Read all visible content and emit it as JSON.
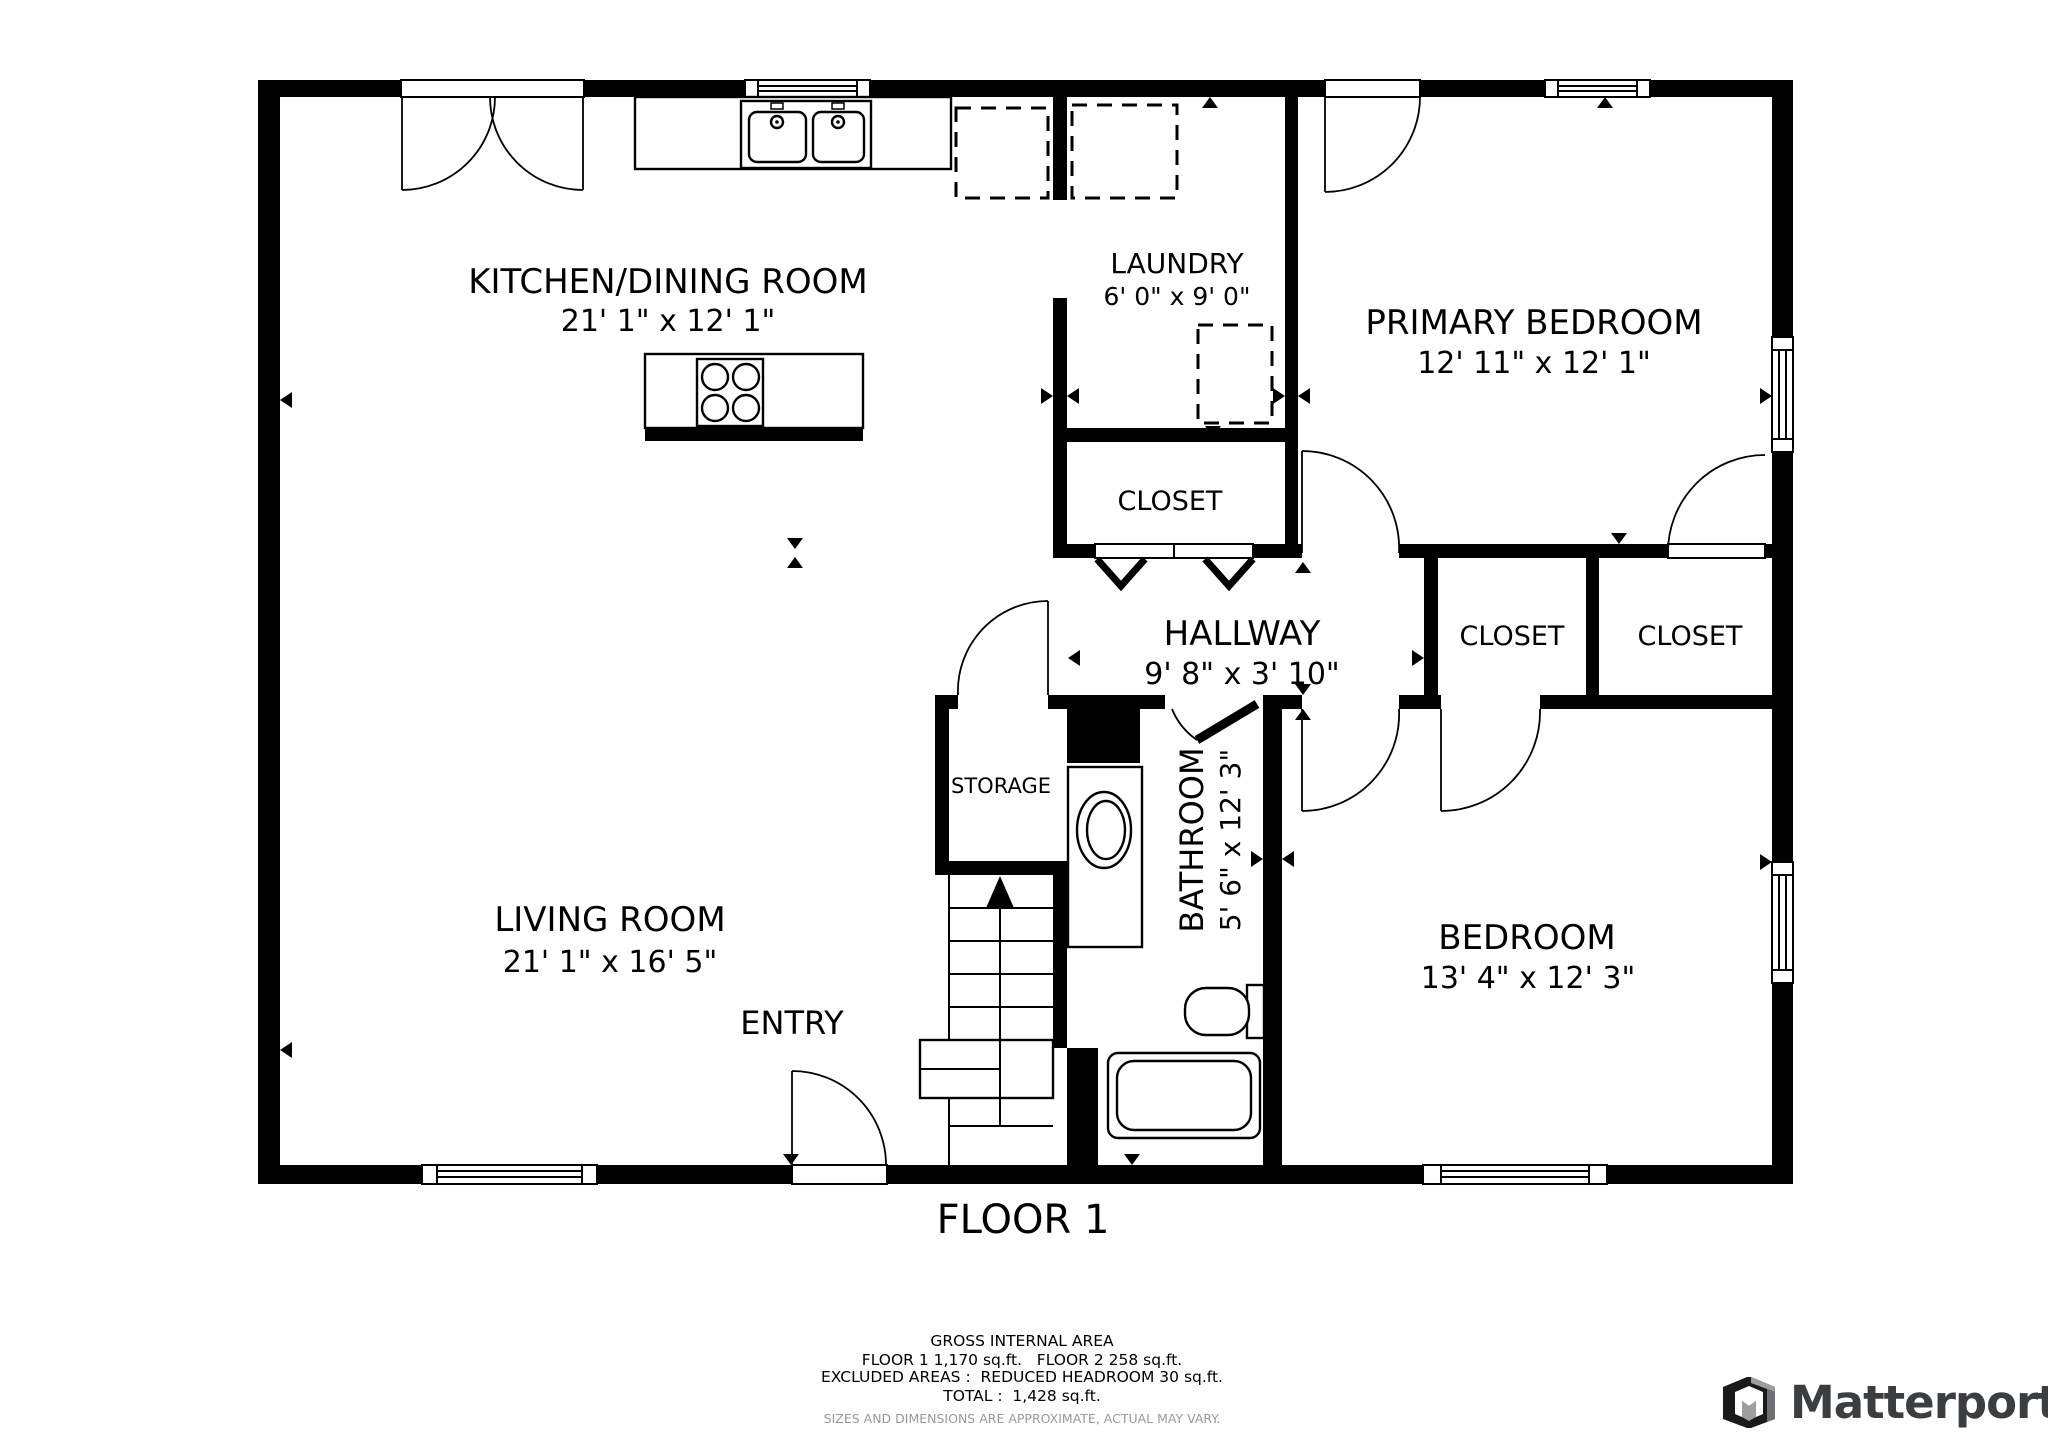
{
  "floor_plan": {
    "rooms": [
      {
        "id": "kitchen-dining",
        "label": "KITCHEN/DINING ROOM",
        "dims": "21' 1\" x 12' 1\""
      },
      {
        "id": "laundry",
        "label": "LAUNDRY",
        "dims": "6' 0\" x 9' 0\""
      },
      {
        "id": "primary-bedroom",
        "label": "PRIMARY BEDROOM",
        "dims": "12' 11\" x 12' 1\""
      },
      {
        "id": "laundry-closet",
        "label": "CLOSET",
        "dims": ""
      },
      {
        "id": "hallway",
        "label": "HALLWAY",
        "dims": "9' 8\" x 3' 10\""
      },
      {
        "id": "closet-left",
        "label": "CLOSET",
        "dims": ""
      },
      {
        "id": "closet-right",
        "label": "CLOSET",
        "dims": ""
      },
      {
        "id": "living-room",
        "label": "LIVING ROOM",
        "dims": "21' 1\" x 16' 5\""
      },
      {
        "id": "storage",
        "label": "STORAGE",
        "dims": ""
      },
      {
        "id": "bathroom",
        "label": "BATHROOM",
        "dims": "5' 6\" x 12' 3\""
      },
      {
        "id": "bedroom",
        "label": "BEDROOM",
        "dims": "13' 4\" x 12' 3\""
      },
      {
        "id": "entry",
        "label": "ENTRY",
        "dims": ""
      }
    ],
    "floor_title": "FLOOR 1",
    "area_summary": {
      "title": "GROSS INTERNAL AREA",
      "line1": "FLOOR 1 1,170 sq.ft.   FLOOR 2 258 sq.ft.",
      "line2": "EXCLUDED AREAS :  REDUCED HEADROOM 30 sq.ft.",
      "line3": "TOTAL :  1,428 sq.ft.",
      "disclaimer": "SIZES AND DIMENSIONS ARE APPROXIMATE, ACTUAL MAY VARY."
    },
    "branding": {
      "logo_text": "Matterport"
    }
  },
  "colors": {
    "wall": "#000000",
    "text": "#000000",
    "disclaimer_text": "#999999",
    "logo_text": "#3b3e40",
    "logo_gray": "#9c9ea1",
    "logo_black": "#1a1a1a"
  }
}
